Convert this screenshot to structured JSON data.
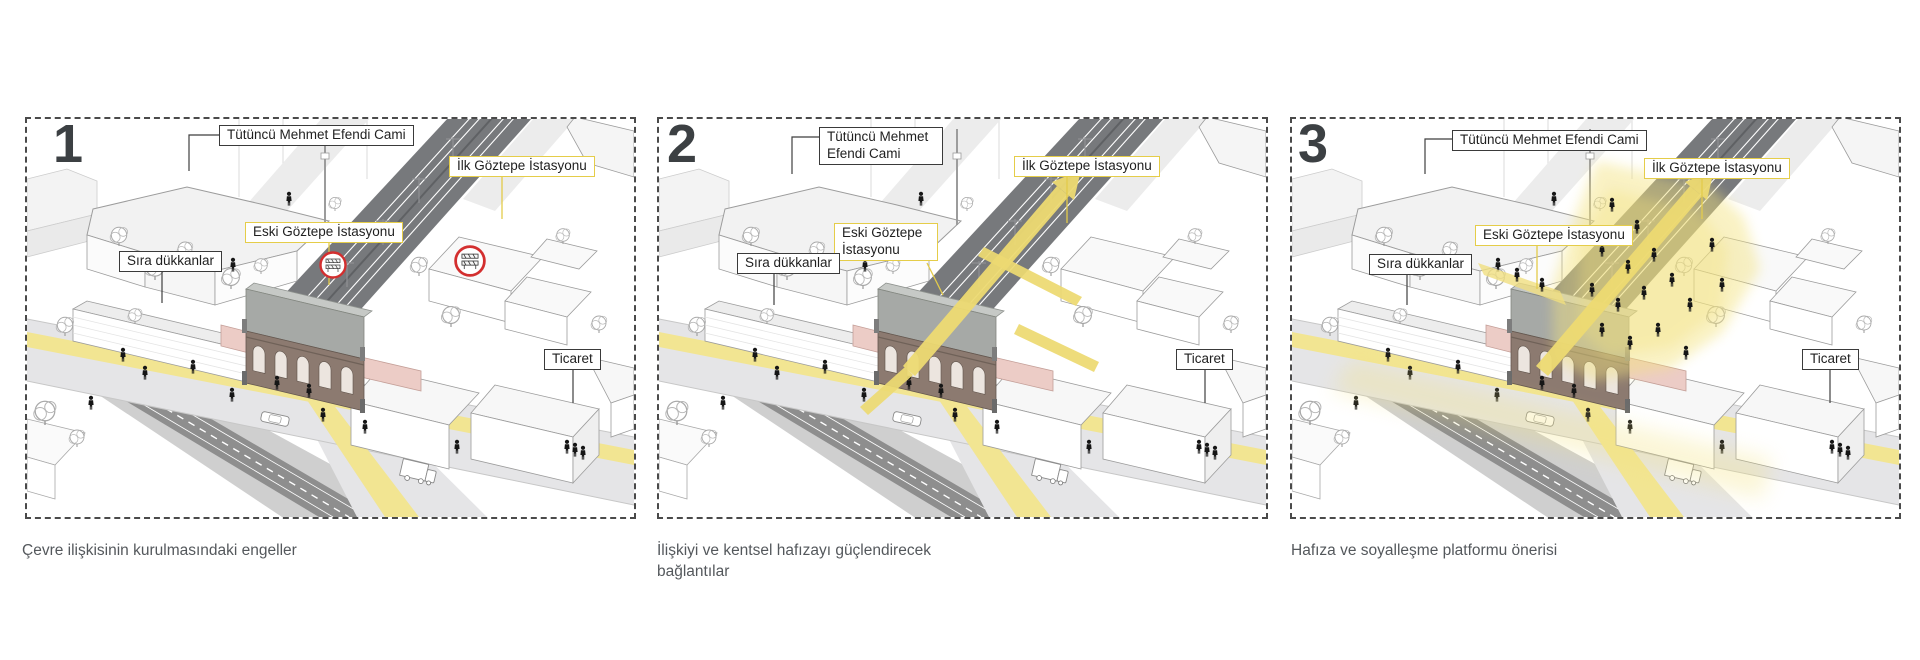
{
  "panels": [
    {
      "number": "1",
      "caption": "Çevre ilişkisinin kurulmasındaki engeller",
      "labels": {
        "mosque": "Tütüncü Mehmet Efendi Cami",
        "new_station": "İlk Göztepe İstasyonu",
        "old_station": "Eski Göztepe İstasyonu",
        "shops": "Sıra dükkanlar",
        "commerce": "Ticaret"
      }
    },
    {
      "number": "2",
      "caption": "İlişkiyi ve kentsel hafızayı güçlendirecek bağlantılar",
      "labels": {
        "mosque": "Tütüncü Mehmet Efendi Cami",
        "new_station": "İlk Göztepe İstasyonu",
        "old_station": "Eski Göztepe İstasyonu",
        "shops": "Sıra dükkanlar",
        "commerce": "Ticaret"
      }
    },
    {
      "number": "3",
      "caption": "Hafıza ve soyalleşme platformu önerisi",
      "labels": {
        "mosque": "Tütüncü Mehmet Efendi Cami",
        "new_station": "İlk Göztepe İstasyonu",
        "old_station": "Eski Göztepe İstasyonu",
        "shops": "Sıra dükkanlar",
        "commerce": "Ticaret"
      }
    }
  ],
  "colors": {
    "highlight_yellow": "#f2e592",
    "connection_yellow": "#edda72",
    "label_yellow_border": "#e5cd49",
    "railway_gray": "#77797c",
    "obstacle_red": "#d32f2f",
    "station_facade_brown": "#8c7a70",
    "station_canopy_pink": "#ecccc6"
  }
}
